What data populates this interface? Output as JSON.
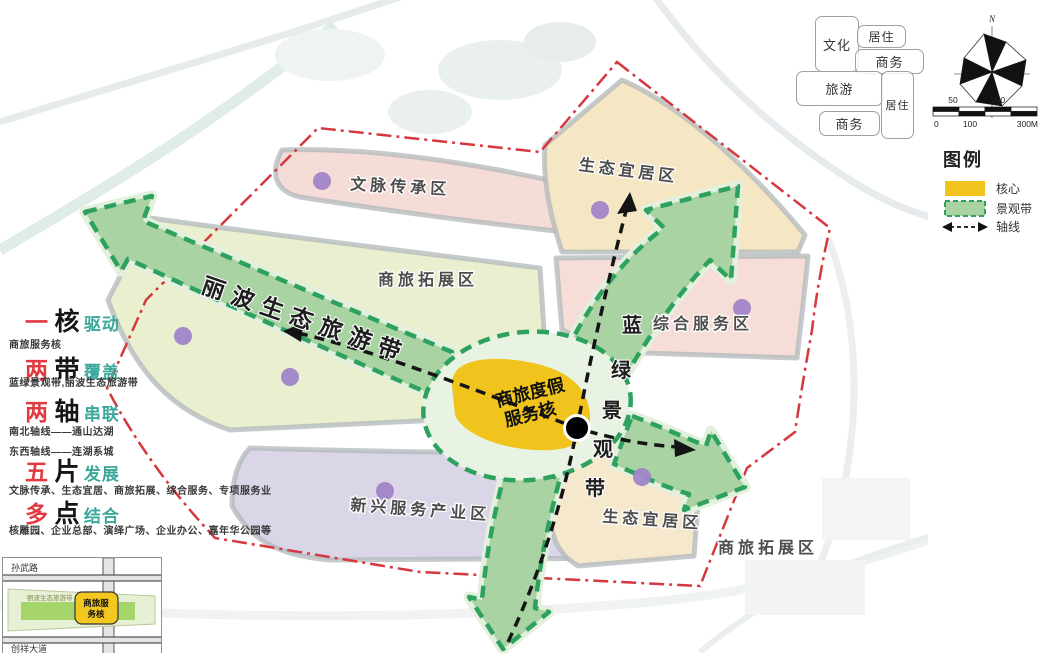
{
  "sidebar": {
    "items": [
      {
        "num": "一",
        "unit": "核",
        "verb": "驱动",
        "lines": [
          "商旅服务核"
        ]
      },
      {
        "num": "两",
        "unit": "带",
        "verb": "覆盖",
        "lines": [
          "蓝绿景观带,丽波生态旅游带"
        ]
      },
      {
        "num": "两",
        "unit": "轴",
        "verb": "串联",
        "lines": [
          "南北轴线——通山达湖",
          "东西轴线——连湖系城"
        ]
      },
      {
        "num": "五",
        "unit": "片",
        "verb": "发展",
        "lines": [
          "文脉传承、生态宜居、商旅拓展、综合服务、专项服务业"
        ]
      },
      {
        "num": "多",
        "unit": "点",
        "verb": "结合",
        "lines": [
          "核雕园、企业总部、演绎广场、企业办公、嘉年华公园等"
        ]
      }
    ]
  },
  "map": {
    "zones": [
      {
        "label": "文脉传承区"
      },
      {
        "label": "商旅拓展区"
      },
      {
        "label": "生态宜居区"
      },
      {
        "label": "综合服务区"
      },
      {
        "label": "新兴服务产业区"
      },
      {
        "label": "生态宜居区"
      },
      {
        "label": "商旅拓展区"
      }
    ],
    "band_diagonal": "丽波生态旅游带",
    "band_vertical": [
      "蓝",
      "绿",
      "景",
      "观",
      "带"
    ],
    "core_line1": "商旅度假",
    "core_line2": "服务核",
    "tags": [
      "文化",
      "居住",
      "商务",
      "旅游",
      "居住",
      "商务"
    ]
  },
  "panel": {
    "north_label": "N",
    "scale": {
      "top": [
        "50",
        "200"
      ],
      "bottom": [
        "0",
        "100",
        "300M"
      ]
    },
    "legend_title": "图例",
    "legend": [
      {
        "label": "核心"
      },
      {
        "label": "景观带"
      },
      {
        "label": "轴线"
      }
    ]
  },
  "inset": {
    "road_top": "孙武路",
    "road_bottom": "创祥大道",
    "band_label": "丽波生态旅游带",
    "core_line1": "商旅服",
    "core_line2": "务核"
  },
  "colors": {
    "core_yellow": "#f0c41c",
    "band_green": "#a9d3a3",
    "band_border": "#2ea15f",
    "boundary_red": "#d5383e",
    "accent_red": "#e13b41",
    "accent_teal": "#3aa89b",
    "dot_purple": "#a184c8",
    "zone_pink": "#f5dcd7",
    "zone_cream": "#f6e7c4",
    "zone_lime": "#e9efcf",
    "zone_lavender": "#dad6e8"
  }
}
